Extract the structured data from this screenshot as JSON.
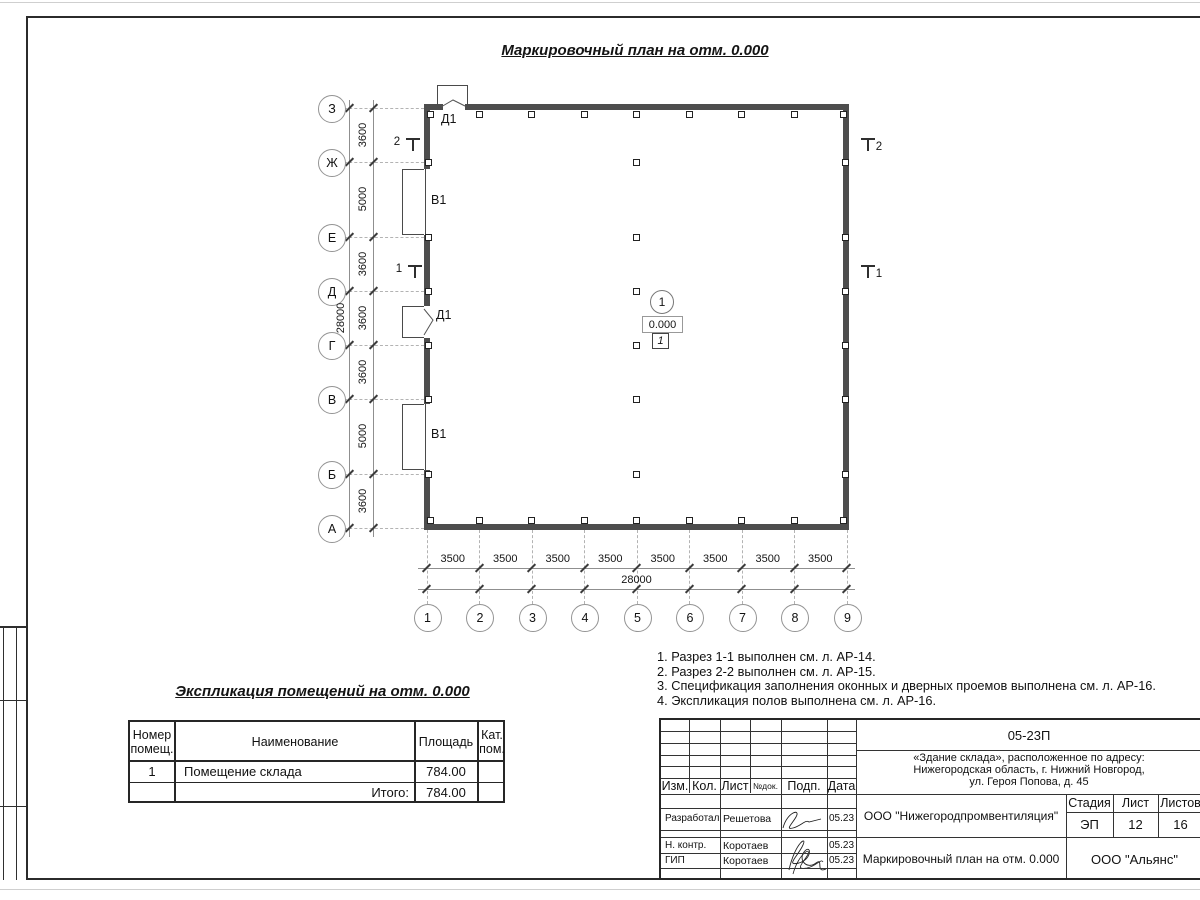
{
  "page_title": "Маркировочный план на отм. 0.000",
  "plan": {
    "v_axes": {
      "labels": [
        "З",
        "Ж",
        "Е",
        "Д",
        "Г",
        "В",
        "Б",
        "А"
      ],
      "segment_dims": [
        "3600",
        "5000",
        "3600",
        "3600",
        "3600",
        "5000",
        "3600"
      ],
      "total_dim": "28000"
    },
    "h_axes": {
      "labels": [
        "1",
        "2",
        "3",
        "4",
        "5",
        "6",
        "7",
        "8",
        "9"
      ],
      "segment_dims": [
        "3500",
        "3500",
        "3500",
        "3500",
        "3500",
        "3500",
        "3500",
        "3500"
      ],
      "total_dim": "28000"
    },
    "opening_labels": [
      "Д1",
      "В1",
      "Д1",
      "В1"
    ],
    "section_marks": [
      "2",
      "1"
    ],
    "room_tag": {
      "number": "1",
      "elevation": "0.000",
      "floor_type": "1"
    }
  },
  "notes": [
    "1. Разрез 1-1 выполнен см. л. АР-14.",
    "2. Разрез 2-2 выполнен см. л. АР-15.",
    "3. Спецификация заполнения оконных и дверных проемов выполнена см. л. АР-16.",
    "4. Экспликация полов выполнена см. л. АР-16."
  ],
  "room_table": {
    "title": "Экспликация помещений на отм. 0.000",
    "headers": [
      "Номер помещ.",
      "Наименование",
      "Площадь",
      "Кат. пом."
    ],
    "rows": [
      {
        "number": "1",
        "name": "Помещение склада",
        "area": "784.00",
        "cat": ""
      }
    ],
    "total_label": "Итого:",
    "total_area": "784.00"
  },
  "stamp": {
    "doc_number": "05-23П",
    "address_lines": [
      "«Здание склада», расположенное по адресу:",
      "Нижегородская область, г. Нижний Новгород,",
      "ул. Героя Попова, д. 45"
    ],
    "rev_headers": [
      "Изм.",
      "Кол.",
      "Лист",
      "№док.",
      "Подп.",
      "Дата"
    ],
    "sign_rows": [
      {
        "role": "Разработал",
        "name": "Решетова",
        "date": "05.23"
      },
      {
        "role": "Н. контр.",
        "name": "Коротаев",
        "date": "05.23"
      },
      {
        "role": "ГИП",
        "name": "Коротаев",
        "date": "05.23"
      }
    ],
    "org": "ООО \"Нижегородпромвентиляция\"",
    "sheet_title": "Маркировочный план на отм. 0.000",
    "stage_label": "Стадия",
    "sheet_label": "Лист",
    "sheets_label": "Листов",
    "stage": "ЭП",
    "sheet": "12",
    "sheets": "16",
    "company": "ООО \"Альянс\""
  }
}
